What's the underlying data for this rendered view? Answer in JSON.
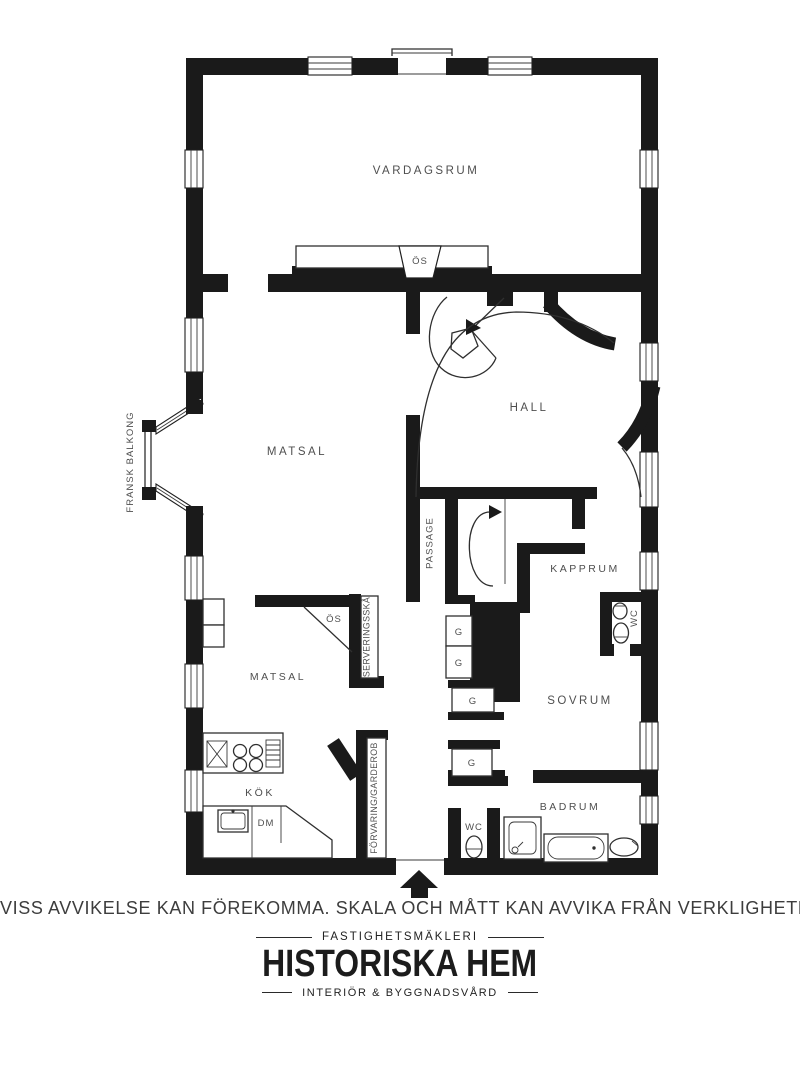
{
  "colors": {
    "wall": "#1a1a1a",
    "label": "#4f4f4f",
    "line": "#2f2f2f",
    "background": "#ffffff"
  },
  "floorplan": {
    "labels": {
      "vardagsrum": "VARDAGSRUM",
      "matsal_upper": "MATSAL",
      "hall": "HALL",
      "passage": "PASSAGE",
      "kapprum": "KAPPRUM",
      "matsal_lower": "MATSAL",
      "kok": "KÖK",
      "sovrum": "SOVRUM",
      "badrum": "BADRUM",
      "fransk_balkong": "FRANSK BALKONG",
      "serveringsskap": "SERVERINGSSKÅ",
      "forvaring_garderob": "FÖRVARING/GARDEROB",
      "os": "ÖS",
      "wc": "WC",
      "dm": "DM",
      "g": "G"
    }
  },
  "footer": {
    "disclaimer": "VISS AVVIKELSE KAN FÖREKOMMA. SKALA OCH MÅTT KAN AVVIKA FRÅN VERKLIGHETEN.",
    "brand": {
      "kicker": "FASTIGHETSMÄKLERI",
      "name": "HISTORISKA HEM",
      "tagline": "INTERIÖR & BYGGNADSVÅRD"
    }
  }
}
